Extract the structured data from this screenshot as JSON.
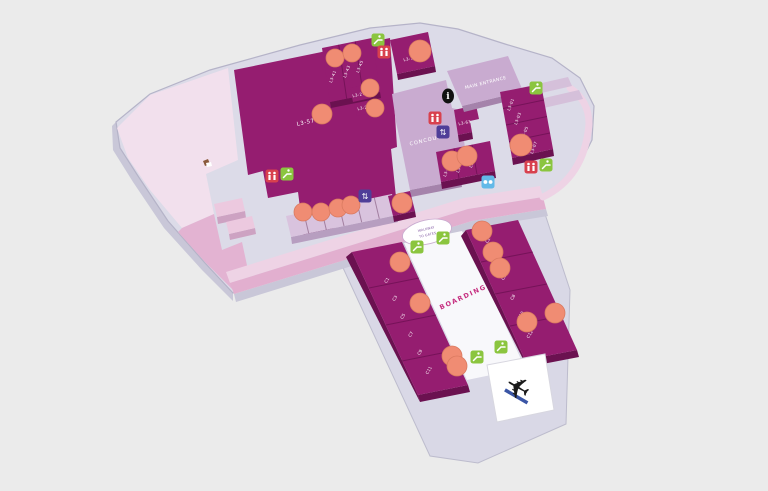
{
  "canvas": {
    "width": 768,
    "height": 491,
    "background": "#ebebeb"
  },
  "palette": {
    "base": "#dcdbe8",
    "platform": "#d9d8e6",
    "magenta": "#951d70",
    "magenta_side": "#6b1150",
    "mauve": "#c9abd0",
    "kiosk": "#d9c3de",
    "pink_light": "#f2e0ed",
    "pink_medium": "#e3b3d2",
    "rose_band": "#e2afcf",
    "marker_orange": "#f08c73",
    "escalator_green": "#8bc53f",
    "toilet_red": "#d8414e",
    "phone_blue": "#62b9e8",
    "lift_purple": "#4f3e98",
    "boarding_pink": "#c62f80",
    "corridor_white": "#f8f8fb"
  },
  "labels": {
    "main_entrance": "MAIN ENTRANCE",
    "concourse": "CONCOURSE",
    "boarding": "BOARDING",
    "big_unit": "L3-57",
    "walkway_line1": "WALKWAY",
    "walkway_line2": "TO GATES",
    "info_glyph": "i"
  },
  "units": [
    {
      "label": "L3-41",
      "x": 334,
      "y": 77,
      "rot": -70
    },
    {
      "label": "L3-43",
      "x": 348,
      "y": 72,
      "rot": -70
    },
    {
      "label": "L3-45",
      "x": 361,
      "y": 67,
      "rot": -70
    },
    {
      "label": "L3-17",
      "x": 410,
      "y": 60,
      "rot": -12
    },
    {
      "label": "L3-21",
      "x": 359,
      "y": 96,
      "rot": -12
    },
    {
      "label": "L3-23",
      "x": 364,
      "y": 109,
      "rot": -12
    },
    {
      "label": "L3-63",
      "x": 465,
      "y": 124,
      "rot": -12
    },
    {
      "label": "L3-01",
      "x": 512,
      "y": 105,
      "rot": -70
    },
    {
      "label": "L3-03",
      "x": 519,
      "y": 119,
      "rot": -70
    },
    {
      "label": "L3-05",
      "x": 526,
      "y": 133,
      "rot": -70
    },
    {
      "label": "L3-07",
      "x": 535,
      "y": 148,
      "rot": -70
    },
    {
      "label": "L3-71",
      "x": 448,
      "y": 171,
      "rot": -70
    },
    {
      "label": "L3-73",
      "x": 461,
      "y": 167,
      "rot": -70
    },
    {
      "label": "L3-75",
      "x": 474,
      "y": 162,
      "rot": -70
    }
  ],
  "gates": [
    {
      "label": "C1",
      "x": 388,
      "y": 281,
      "rot": -60
    },
    {
      "label": "C3",
      "x": 396,
      "y": 299,
      "rot": -60
    },
    {
      "label": "C5",
      "x": 404,
      "y": 317,
      "rot": -60
    },
    {
      "label": "C7",
      "x": 412,
      "y": 335,
      "rot": -60
    },
    {
      "label": "C9",
      "x": 421,
      "y": 353,
      "rot": -60
    },
    {
      "label": "C11",
      "x": 430,
      "y": 371,
      "rot": -60
    },
    {
      "label": "C2",
      "x": 489,
      "y": 241,
      "rot": -60
    },
    {
      "label": "C4",
      "x": 497,
      "y": 260,
      "rot": -60
    },
    {
      "label": "C6",
      "x": 505,
      "y": 278,
      "rot": -60
    },
    {
      "label": "C8",
      "x": 514,
      "y": 298,
      "rot": -60
    },
    {
      "label": "C10",
      "x": 522,
      "y": 316,
      "rot": -60
    },
    {
      "label": "C12",
      "x": 531,
      "y": 335,
      "rot": -60
    }
  ],
  "markers": [
    {
      "x": 335,
      "y": 58,
      "r": 9
    },
    {
      "x": 352,
      "y": 53,
      "r": 9
    },
    {
      "x": 420,
      "y": 51,
      "r": 11
    },
    {
      "x": 370,
      "y": 88,
      "r": 9
    },
    {
      "x": 375,
      "y": 108,
      "r": 9
    },
    {
      "x": 322,
      "y": 114,
      "r": 10
    },
    {
      "x": 521,
      "y": 145,
      "r": 11
    },
    {
      "x": 452,
      "y": 161,
      "r": 10
    },
    {
      "x": 467,
      "y": 156,
      "r": 10
    },
    {
      "x": 303,
      "y": 212,
      "r": 9
    },
    {
      "x": 321,
      "y": 212,
      "r": 9
    },
    {
      "x": 338,
      "y": 208,
      "r": 9
    },
    {
      "x": 351,
      "y": 205,
      "r": 9
    },
    {
      "x": 402,
      "y": 203,
      "r": 10
    },
    {
      "x": 400,
      "y": 262,
      "r": 10
    },
    {
      "x": 420,
      "y": 303,
      "r": 10
    },
    {
      "x": 452,
      "y": 356,
      "r": 10
    },
    {
      "x": 457,
      "y": 366,
      "r": 10
    },
    {
      "x": 482,
      "y": 231,
      "r": 10
    },
    {
      "x": 493,
      "y": 252,
      "r": 10
    },
    {
      "x": 500,
      "y": 268,
      "r": 10
    },
    {
      "x": 527,
      "y": 322,
      "r": 10
    },
    {
      "x": 555,
      "y": 313,
      "r": 10
    }
  ],
  "icons": {
    "escalator": [
      {
        "x": 378,
        "y": 40
      },
      {
        "x": 287,
        "y": 174
      },
      {
        "x": 536,
        "y": 88
      },
      {
        "x": 546,
        "y": 165
      },
      {
        "x": 443,
        "y": 238
      },
      {
        "x": 417,
        "y": 247
      },
      {
        "x": 501,
        "y": 347
      },
      {
        "x": 477,
        "y": 357
      }
    ],
    "toilets": [
      {
        "x": 384,
        "y": 52
      },
      {
        "x": 272,
        "y": 176
      },
      {
        "x": 531,
        "y": 167
      },
      {
        "x": 435,
        "y": 118
      }
    ],
    "lift": [
      {
        "x": 443,
        "y": 132
      },
      {
        "x": 365,
        "y": 196
      }
    ],
    "phones": [
      {
        "x": 488,
        "y": 182
      }
    ],
    "info": [
      {
        "x": 448,
        "y": 96
      }
    ],
    "cart": [
      {
        "x": 207,
        "y": 163
      }
    ],
    "airplane": [
      {
        "x": 517,
        "y": 389,
        "rot": 30
      }
    ]
  }
}
